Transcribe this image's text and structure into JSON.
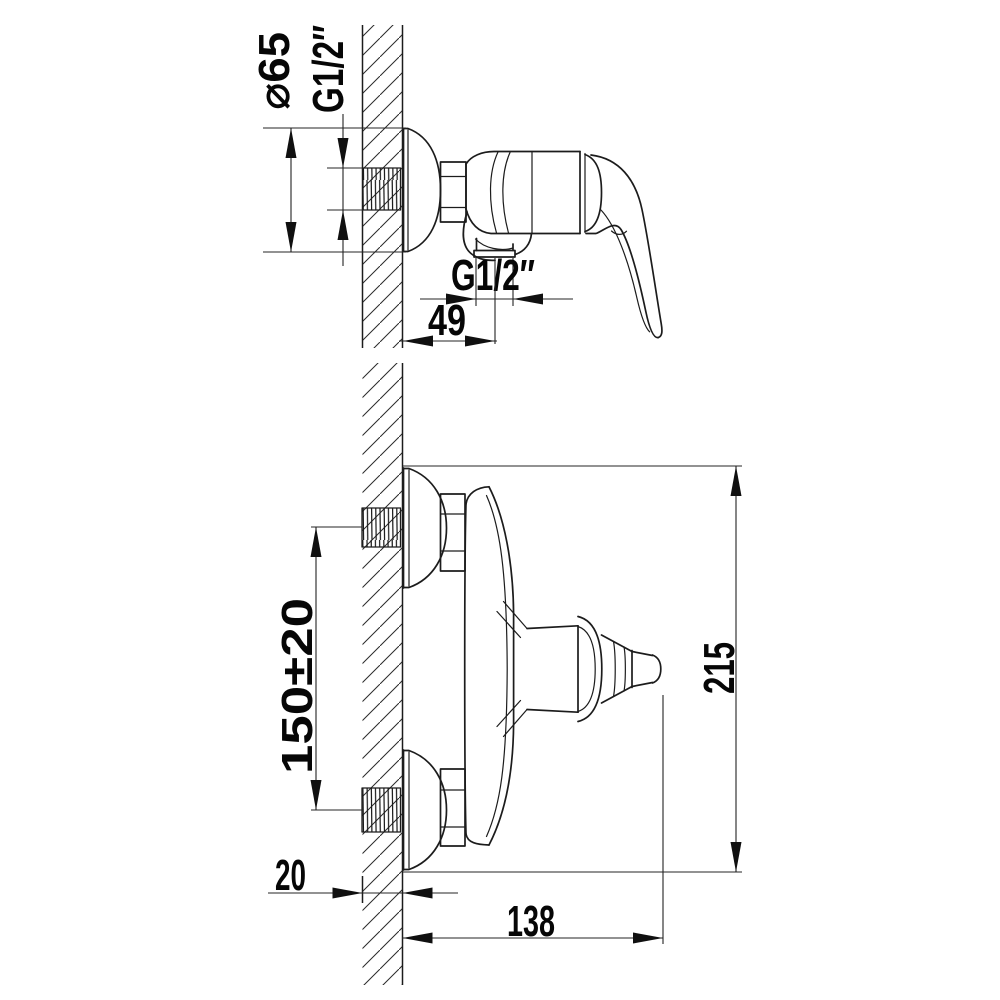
{
  "drawing": {
    "title": "shower-mixer-dimension-drawing",
    "background": "#ffffff",
    "line_color": "#1c1c1c",
    "side_view": {
      "escutcheon_diameter_label": "⌀65",
      "inlet_thread_label": "G1/2″",
      "outlet_thread_label": "G1/2″",
      "outlet_offset_label": "49"
    },
    "plan_view": {
      "inlet_spacing_label": "150±20",
      "overall_width_label": "215",
      "wall_thickness_label": "20",
      "projection_label": "138"
    }
  }
}
